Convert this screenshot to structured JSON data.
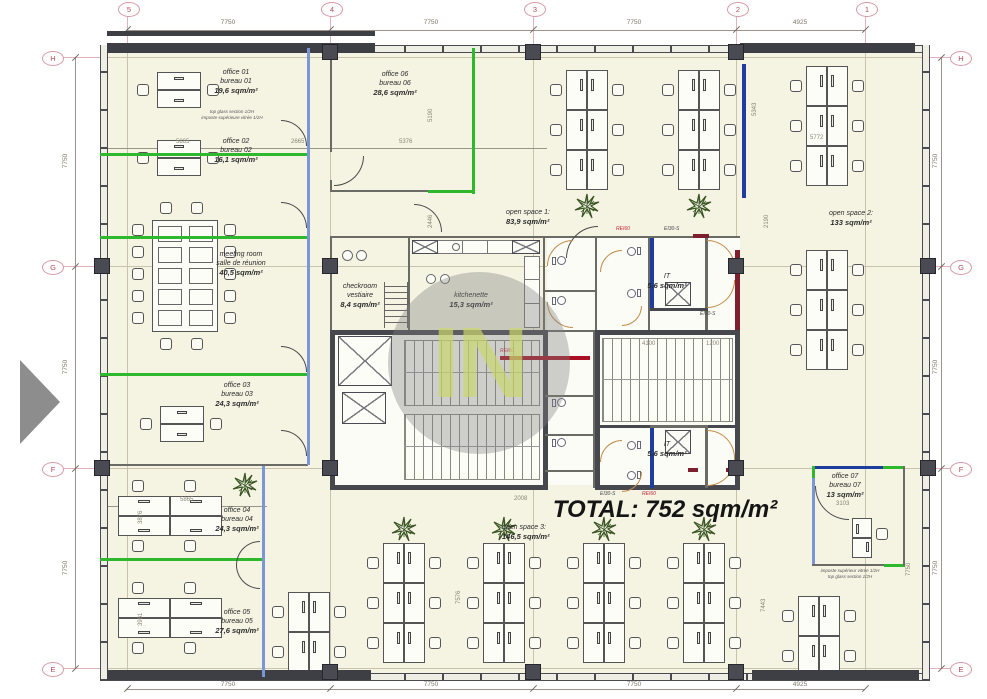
{
  "total_label": "TOTAL: 752 sqm/m²",
  "watermark": "IN",
  "grid": {
    "top_bubbles": [
      "5",
      "4",
      "3",
      "2",
      "1"
    ],
    "side_bubbles": [
      "H",
      "G",
      "F",
      "E"
    ],
    "top_dims": [
      "7750",
      "7750",
      "7750",
      "4925"
    ],
    "bottom_dims": [
      "7750",
      "7750",
      "7750",
      "4925"
    ],
    "left_dims": [
      "7750",
      "7750",
      "7750"
    ],
    "right_dims": [
      "7750",
      "7750",
      "7750"
    ]
  },
  "rooms": {
    "office01": {
      "l1": "office 01",
      "l2": "bureau 01",
      "area": "19,6 sqm/m²",
      "note1": "top glass section 1/2H",
      "note2": "imposte supérieure vitrée 1/2H"
    },
    "office02": {
      "l1": "office 02",
      "l2": "bureau 02",
      "area": "16,1 sqm/m²"
    },
    "office03": {
      "l1": "office 03",
      "l2": "bureau 03",
      "area": "24,3 sqm/m²"
    },
    "office04": {
      "l1": "office 04",
      "l2": "bureau 04",
      "area": "24,3 sqm/m²"
    },
    "office05": {
      "l1": "office 05",
      "l2": "bureau 05",
      "area": "27,6 sqm/m²"
    },
    "office06": {
      "l1": "office 06",
      "l2": "bureau 06",
      "area": "28,6 sqm/m²"
    },
    "office07": {
      "l1": "office 07",
      "l2": "bureau 07",
      "area": "13 sqm/m²",
      "note1": "imposte supérieur vitrée 1/2H",
      "note2": "top glass section 1/2H"
    },
    "meeting": {
      "l1": "meeting room",
      "l2": "salle de réunion",
      "area": "40,5 sqm/m²"
    },
    "checkroom": {
      "l1": "checkroom",
      "l2": "vestiaire",
      "area": "8,4 sqm/m²"
    },
    "kitchenette": {
      "l1": "kitchenette",
      "area": "15,3 sqm/m²"
    },
    "open1": {
      "l1": "open space 1:",
      "area": "83,9 sqm/m²"
    },
    "open2": {
      "l1": "open space 2:",
      "area": "133 sqm/m²"
    },
    "open3": {
      "l1": "open space 3:",
      "area": "146,5 sqm/m²"
    },
    "it1": {
      "l1": "IT",
      "area": "5,6 sqm/m²"
    },
    "it2": {
      "l1": "IT",
      "area": "5,6 sqm/m²"
    }
  },
  "dims": {
    "a5865": "5865",
    "a2665": "2665",
    "a5376": "5376",
    "a5190": "5190",
    "a2446": "2446",
    "a5343": "5343",
    "a5772": "5772",
    "a2190": "2190",
    "b5865": "5865",
    "a3876": "3876",
    "a3961": "3961",
    "a3103": "3103",
    "a7443": "7443",
    "a7576": "7576",
    "a7750": "7750",
    "a4100": "4100",
    "a1200": "1200",
    "a2008": "2008"
  },
  "fire": {
    "rei60": "REI60",
    "ei30": "EI30-S"
  },
  "colors": {
    "green_partition": "#2eb82e",
    "glazing_blue": "#7b96d4",
    "it_blue": "#1f3d9e",
    "fire_maroon": "#7d1f2e",
    "fire_red_text": "#cc2233",
    "core_wall": "#47474e",
    "floor": "#f5f4e3",
    "watermark_green": "#cad86c"
  }
}
